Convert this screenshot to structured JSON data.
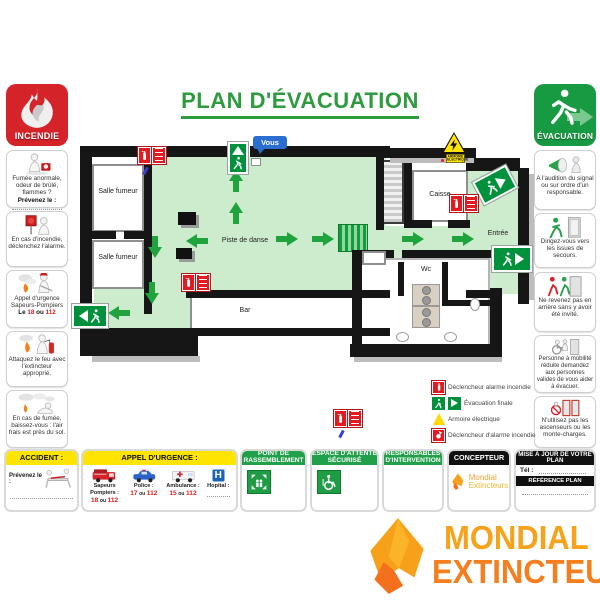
{
  "title": "PLAN D'ÉVACUATION",
  "incendie": {
    "badge": "INCENDIE",
    "items": [
      {
        "text": "Fumée anormale, odeur de brûlé, flammes ?",
        "bold": "Prévenez le :"
      },
      {
        "text": "En cas d'incendie, déclenchez l'alarme."
      },
      {
        "text": "Appel d'urgence Sapeurs-Pompiers",
        "pre": "Le",
        "n1": "18",
        "sep": "ou",
        "n2": "112"
      },
      {
        "text": "Attaquez le feu avec l'extincteur approprié."
      },
      {
        "text": "En cas de fumée, baissez-vous : l'air frais est près du sol."
      }
    ]
  },
  "evacuation": {
    "badge": "ÉVACUATION",
    "items": [
      {
        "text": "A l'audition du signal ou sur ordre d'un responsable."
      },
      {
        "text": "Dirigez-vous vers les issues de secours."
      },
      {
        "text": "Ne revenez pas en arrière sans y avoir été invité."
      },
      {
        "text": "Personne à mobilité réduite demandez aux personnes valides de vous aider à évacuer."
      },
      {
        "text": "N'utilisez pas les ascenseurs ou les monte-charges."
      }
    ]
  },
  "plan": {
    "you_are_here": "Vous",
    "rooms": {
      "salle_fumeur_1": "Salle fumeur",
      "salle_fumeur_2": "Salle fumeur",
      "piste": "Piste de danse",
      "bar": "Bar",
      "caisse": "Caisse",
      "entree": "Entrée",
      "wc": "Wc"
    },
    "armoire_line1": "ARMOIRE",
    "armoire_line2": "ELECTRIQUE",
    "legend": [
      {
        "label": "Déclencheur alarme incendie"
      },
      {
        "label": "Évacuation finale"
      },
      {
        "label": "Armoire électrique"
      },
      {
        "label": "Déclencheur d'alarme incendie"
      }
    ]
  },
  "footer": {
    "accident": {
      "title": "ACCIDENT :",
      "notify": "Prévenez le :"
    },
    "urgence": {
      "title": "APPEL D'URGENCE :",
      "entries": [
        {
          "label": "Sapeurs Pompiers :",
          "n1": "18",
          "sep": "ou",
          "n2": "112"
        },
        {
          "label": "Police :",
          "n1": "17",
          "sep": "ou",
          "n2": "112"
        },
        {
          "label": "Ambulance :",
          "n1": "15",
          "sep": "ou",
          "n2": "112"
        },
        {
          "label": "Hopital :"
        }
      ]
    },
    "rassemblement": {
      "title": "POINT DE RASSEMBLEMENT"
    },
    "attente": {
      "title": "ESPACE D'ATTENTE SÉCURISÉ"
    },
    "responsables": {
      "title": "RESPONSABLES D'INTERVENTION"
    },
    "concepteur": {
      "title": "CONCEPTEUR",
      "brand_line1": "Mondial",
      "brand_line2": "Extincteurs"
    },
    "mise_a_jour": {
      "title": "MISE À JOUR DE VOTRE PLAN",
      "tel_label": "Tél :",
      "reference": "RÉFÉRENCE PLAN"
    }
  },
  "logo": {
    "line1": "MONDIAL",
    "line2": "EXTINCTEUR"
  },
  "colors": {
    "title_green": "#2e9b3e",
    "header_green": "#21a04a",
    "floor_green": "#cdeccd",
    "arrow_green": "#1fa33c",
    "exit_sign_green": "#00913c",
    "badge_red": "#d5232a",
    "sign_red": "#e21b22",
    "panel_yellow": "#ffe400",
    "logo_orange_1": "#f6a21a",
    "logo_orange_2": "#f57e1f",
    "marker_blue": "#2a6fd0"
  }
}
